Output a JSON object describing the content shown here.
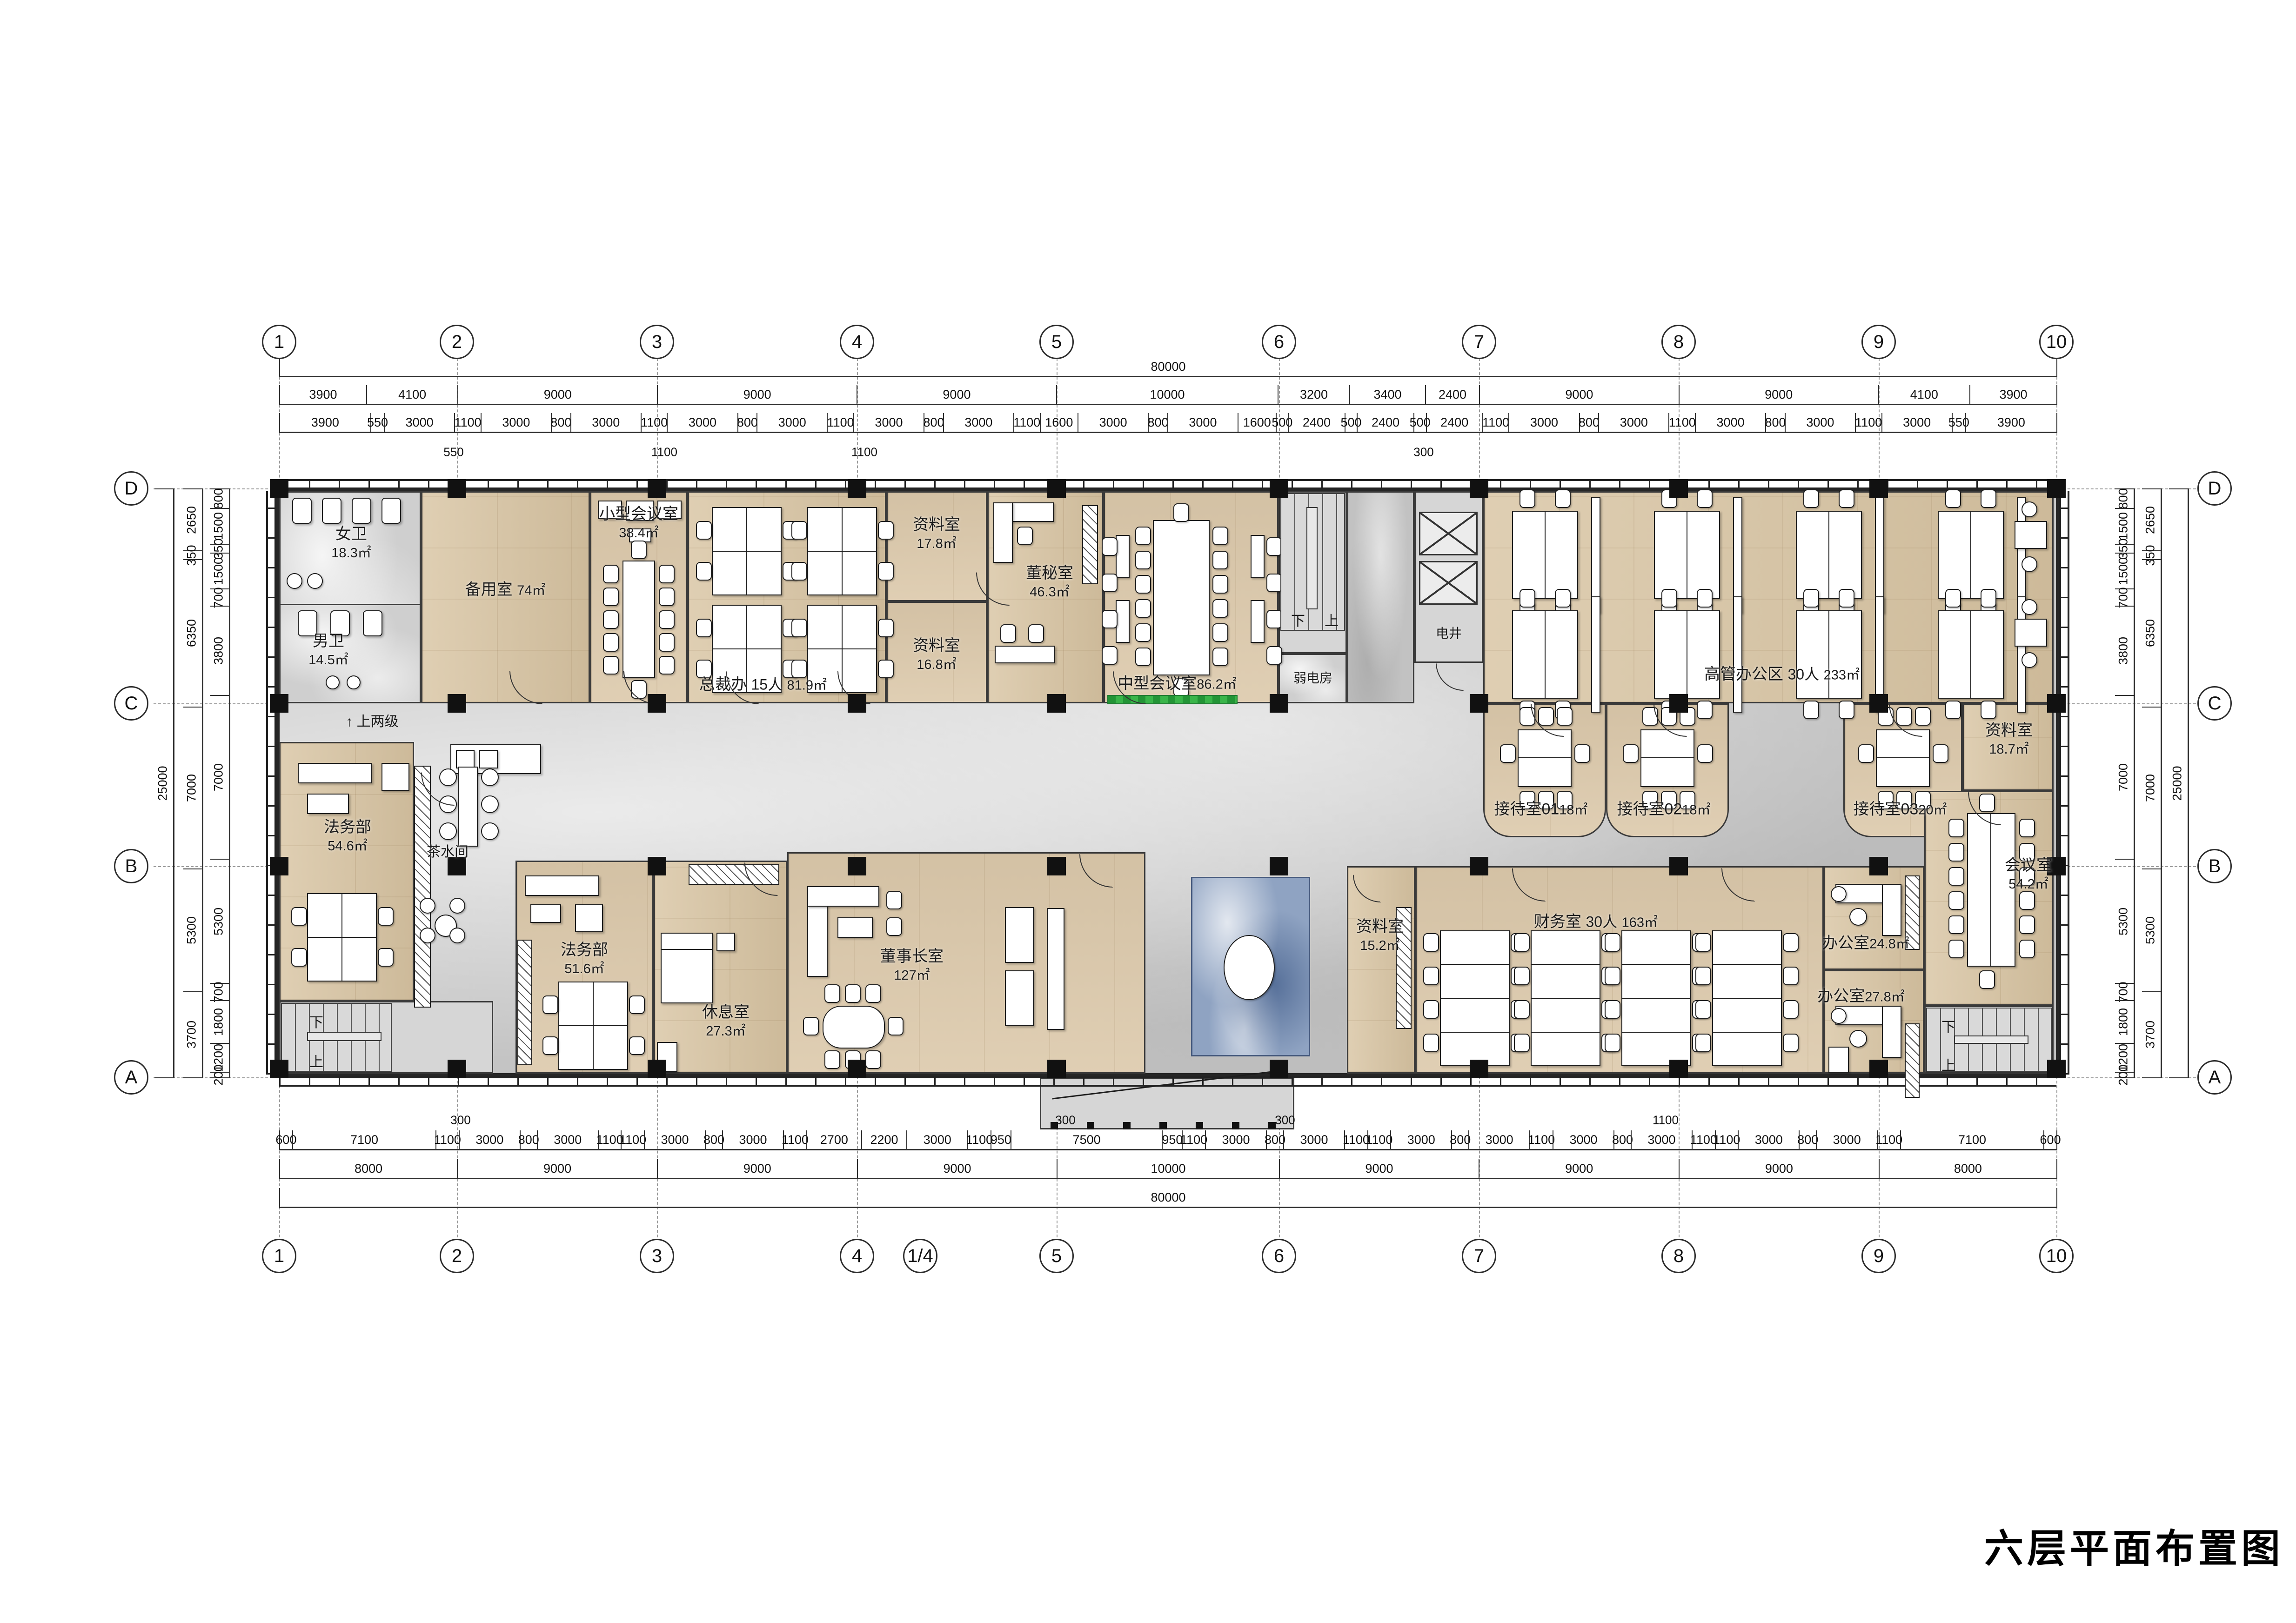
{
  "sheet": {
    "title": "六层平面布置图"
  },
  "grid": {
    "cols_top": [
      "1",
      "2",
      "3",
      "4",
      "5",
      "6",
      "7",
      "8",
      "9",
      "10"
    ],
    "cols_bottom": [
      "1",
      "2",
      "3",
      "4",
      "1/4",
      "5",
      "6",
      "7",
      "8",
      "9",
      "10"
    ],
    "rows_left": [
      "D",
      "C",
      "B",
      "A"
    ],
    "rows_right": [
      "D",
      "C",
      "B",
      "A"
    ]
  },
  "dims": {
    "top": {
      "total": "80000",
      "spans": [
        "3900",
        "4100",
        "9000",
        "9000",
        "9000",
        "10000",
        "3200",
        "3400",
        "2400",
        "9000",
        "9000",
        "4100",
        "3900"
      ],
      "detail": [
        "3900",
        "550",
        "3000",
        "1100",
        "3000",
        "800",
        "3000",
        "1100",
        "3000",
        "800",
        "3000",
        "1100",
        "3000",
        "800",
        "3000",
        "1100",
        "1600",
        "3000",
        "800",
        "3000",
        "1600",
        "500",
        "2400",
        "500",
        "2400",
        "500",
        "2400",
        "1100",
        "3000",
        "800",
        "3000",
        "1100",
        "3000",
        "800",
        "3000",
        "1100",
        "3000",
        "550",
        "3900"
      ],
      "callouts": [
        "550",
        "1100",
        "1100",
        "300"
      ]
    },
    "bottom": {
      "total": "80000",
      "spans": [
        "8000",
        "9000",
        "9000",
        "9000",
        "10000",
        "9000",
        "9000",
        "9000",
        "8000"
      ],
      "detail": [
        "600",
        "7100",
        "1100",
        "3000",
        "800",
        "3000",
        "1100",
        "1100",
        "3000",
        "800",
        "3000",
        "1100",
        "2700",
        "2200",
        "3000",
        "1100",
        "950",
        "7500",
        "950",
        "1100",
        "3000",
        "800",
        "3000",
        "1100",
        "1100",
        "3000",
        "800",
        "3000",
        "1100",
        "3000",
        "800",
        "3000",
        "1100",
        "1100",
        "3000",
        "800",
        "3000",
        "1100",
        "7100",
        "600"
      ],
      "callouts": [
        "300",
        "300",
        "300",
        "1100"
      ]
    },
    "left": {
      "total": "25000",
      "spans": [
        "2650",
        "350",
        "6350",
        "7000",
        "5300",
        "3700"
      ],
      "detail": [
        "800",
        "1500",
        "350",
        "1500",
        "700",
        "3800",
        "7000",
        "5300",
        "700",
        "1800",
        "1200",
        "200"
      ]
    },
    "right": {
      "total": "25000",
      "spans": [
        "2650",
        "350",
        "6350",
        "7000",
        "5300",
        "3700"
      ],
      "detail": [
        "800",
        "1500",
        "350",
        "1500",
        "700",
        "3800",
        "7000",
        "5300",
        "700",
        "1800",
        "1200",
        "200"
      ]
    }
  },
  "rooms": {
    "nvwei": {
      "name": "女卫",
      "area": "18.3㎡"
    },
    "nanwei": {
      "name": "男卫",
      "area": "14.5㎡"
    },
    "beiyong": {
      "name": "备用室",
      "area": "74㎡"
    },
    "xiaohui": {
      "name": "小型会议室",
      "area": "38.4㎡"
    },
    "zongcai": {
      "name": "总裁办",
      "persons": "15人",
      "area": "81.9㎡"
    },
    "ziliao178": {
      "name": "资料室",
      "area": "17.8㎡"
    },
    "ziliao168": {
      "name": "资料室",
      "area": "16.8㎡"
    },
    "dongmi": {
      "name": "董秘室",
      "area": "46.3㎡"
    },
    "zhonghui": {
      "name": "中型会议室",
      "area": "86.2㎡"
    },
    "ruodian": {
      "name": "弱电房"
    },
    "dianjing": {
      "name": "电井"
    },
    "gaoguan": {
      "name": "高管办公区",
      "persons": "30人",
      "area": "233㎡"
    },
    "jiedai01": {
      "name": "接待室01",
      "area": "18㎡"
    },
    "jiedai02": {
      "name": "接待室02",
      "area": "18㎡"
    },
    "jiedai03": {
      "name": "接待室03",
      "area": "20㎡"
    },
    "ziliao187": {
      "name": "资料室",
      "area": "18.7㎡"
    },
    "huiyi542": {
      "name": "会议室",
      "area": "54.2㎡"
    },
    "fawu546": {
      "name": "法务部",
      "area": "54.6㎡"
    },
    "chashui": {
      "name": "茶水间"
    },
    "fawu516": {
      "name": "法务部",
      "area": "51.6㎡"
    },
    "xiuxi": {
      "name": "休息室",
      "area": "27.3㎡"
    },
    "dongshi": {
      "name": "董事长室",
      "area": "127㎡"
    },
    "ziliao152": {
      "name": "资料室",
      "area": "15.2㎡"
    },
    "caiwu": {
      "name": "财务室",
      "persons": "30人",
      "area": "163㎡"
    },
    "bangong248": {
      "name": "办公室",
      "area": "24.8㎡"
    },
    "bangong278": {
      "name": "办公室",
      "area": "27.8㎡"
    }
  },
  "annotations": {
    "up_two_steps": "上两级",
    "up_arrow": "↑",
    "down": "下",
    "up": "上"
  }
}
